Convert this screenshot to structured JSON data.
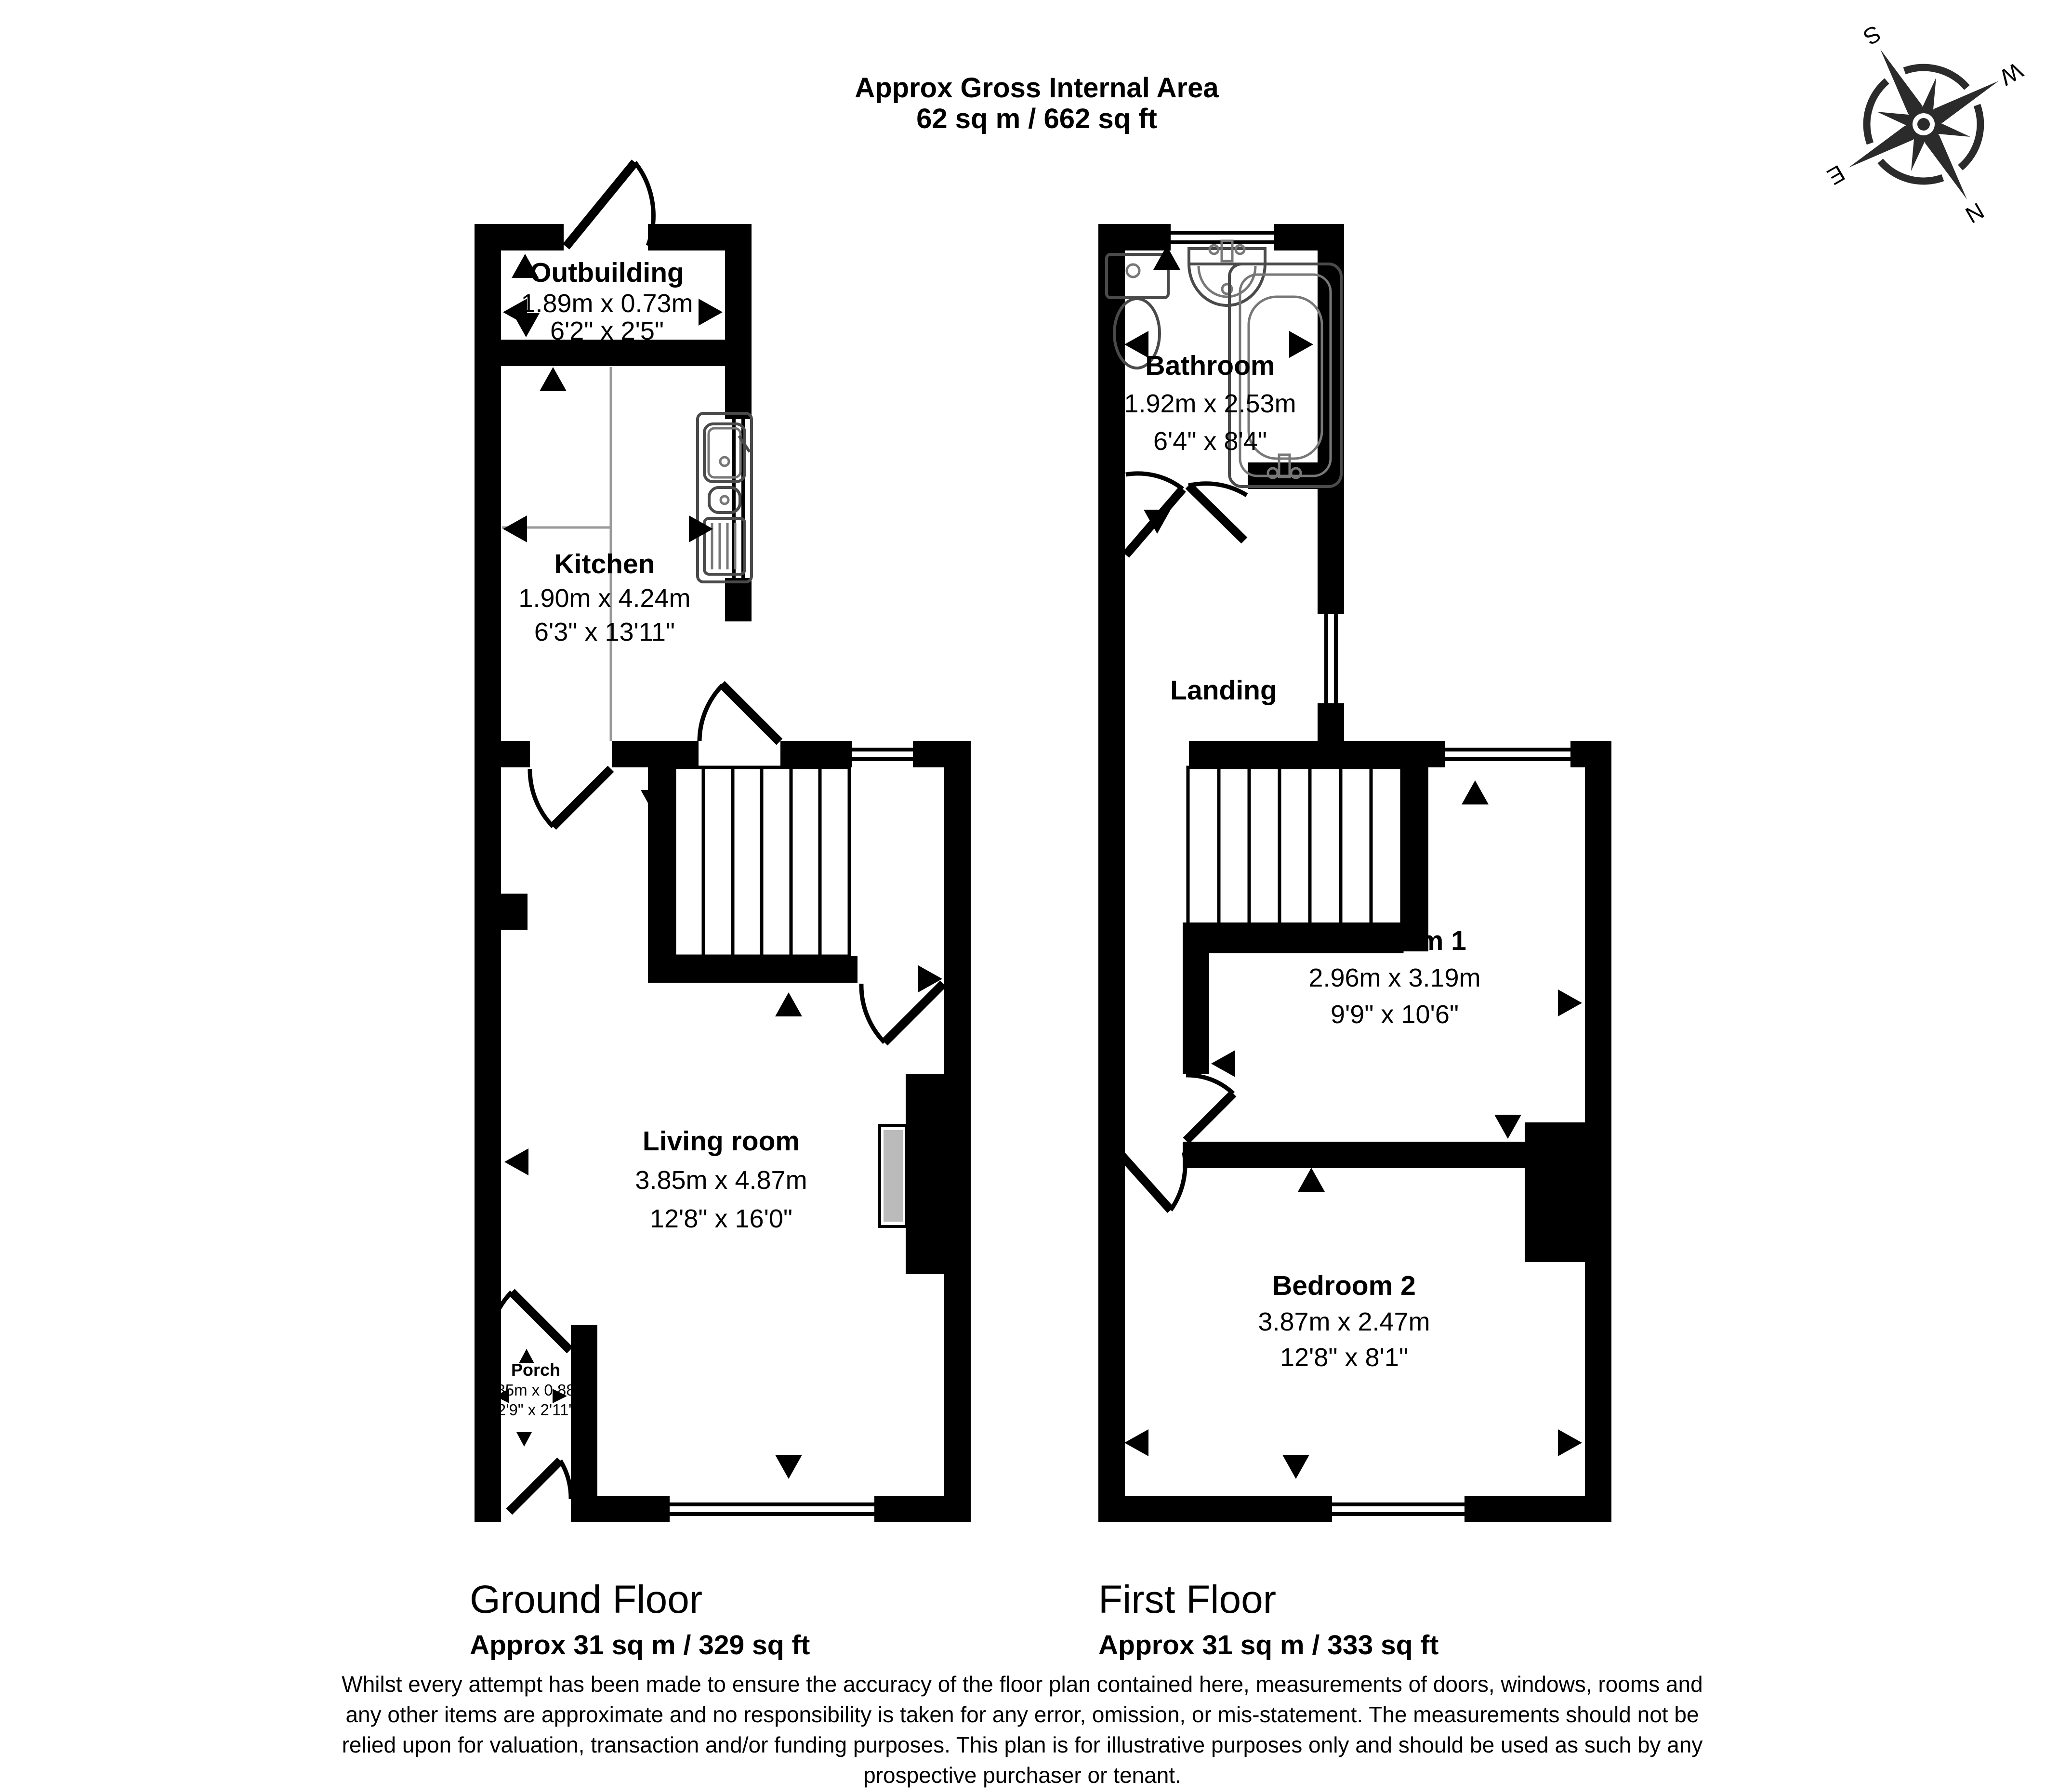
{
  "header": {
    "title_line1": "Approx Gross Internal Area",
    "title_line2": "62 sq m / 662 sq ft"
  },
  "compass": {
    "n": "N",
    "e": "E",
    "s": "S",
    "w": "W"
  },
  "ground_floor": {
    "name": "Ground Floor",
    "area": "Approx 31 sq m / 329 sq ft",
    "rooms": [
      {
        "name": "Outbuilding",
        "metric": "1.89m x 0.73m",
        "imperial": "6'2\" x 2'5\""
      },
      {
        "name": "Kitchen",
        "metric": "1.90m x 4.24m",
        "imperial": "6'3\" x 13'11\""
      },
      {
        "name": "Living room",
        "metric": "3.85m x 4.87m",
        "imperial": "12'8\" x 16'0\""
      },
      {
        "name": "Porch",
        "metric": "0.85m x 0.88m",
        "imperial": "2'9\" x 2'11\""
      }
    ]
  },
  "first_floor": {
    "name": "First Floor",
    "area": "Approx 31 sq m / 333 sq ft",
    "rooms": [
      {
        "name": "Bathroom",
        "metric": "1.92m x 2.53m",
        "imperial": "6'4\" x 8'4\""
      },
      {
        "name": "Landing",
        "metric": "",
        "imperial": ""
      },
      {
        "name": "Bedroom 1",
        "metric": "2.96m x 3.19m",
        "imperial": "9'9\" x 10'6\""
      },
      {
        "name": "Bedroom 2",
        "metric": "3.87m x 2.47m",
        "imperial": "12'8\" x 8'1\""
      }
    ]
  },
  "disclaimer": [
    "Whilst every attempt has been made to ensure the accuracy of the floor plan contained here, measurements of doors, windows, rooms and",
    "any other items are approximate and no responsibility is taken for any error, omission, or mis-statement. The measurements should not be",
    "relied upon for valuation, transaction and/or funding purposes. This plan is for illustrative purposes only and should be used as such by any",
    "prospective purchaser or tenant."
  ]
}
